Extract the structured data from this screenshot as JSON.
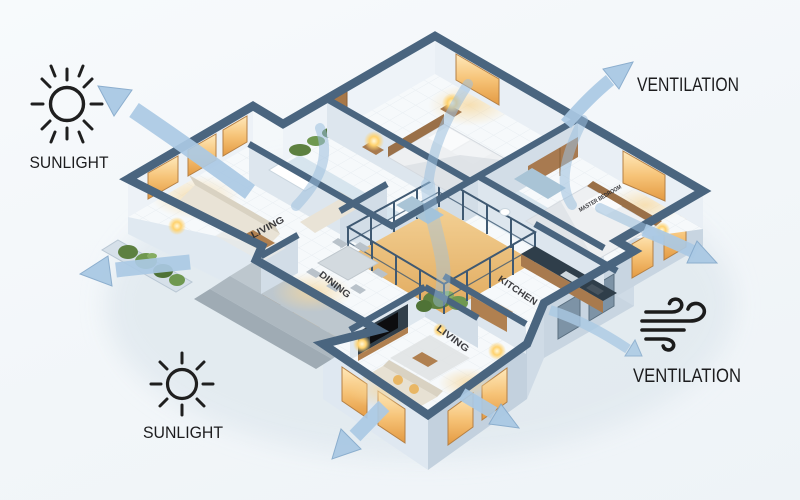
{
  "annotations": {
    "sunlight_top_left": "SUNLIGHT",
    "sunlight_bottom_left": "SUNLIGHT",
    "ventilation_top_right": "VENTILATION",
    "ventilation_bottom_right": "VENTILATION"
  },
  "rooms": {
    "living_left": "LIVING",
    "dining": "DINING",
    "kitchen": "KITCHEN",
    "living_bottom": "LIVING",
    "master_bedroom": "MASTER BEDROOM"
  },
  "icons": {
    "sun": "sun-icon",
    "wind": "wind-icon",
    "airflow_arrow": "airflow-arrow"
  },
  "colors": {
    "background": "#f4f7fa",
    "wall_top": "#4a657f",
    "wall_face_light": "#dde7f0",
    "wall_face_shade": "#c8d5e1",
    "airflow_fill": "#aac9e4",
    "airflow_edge": "#87abcc",
    "window_warm": "#f2b35c",
    "wood": "#a87a4e",
    "greenery": "#6a9048",
    "annotation_text": "#1c1c1e"
  }
}
